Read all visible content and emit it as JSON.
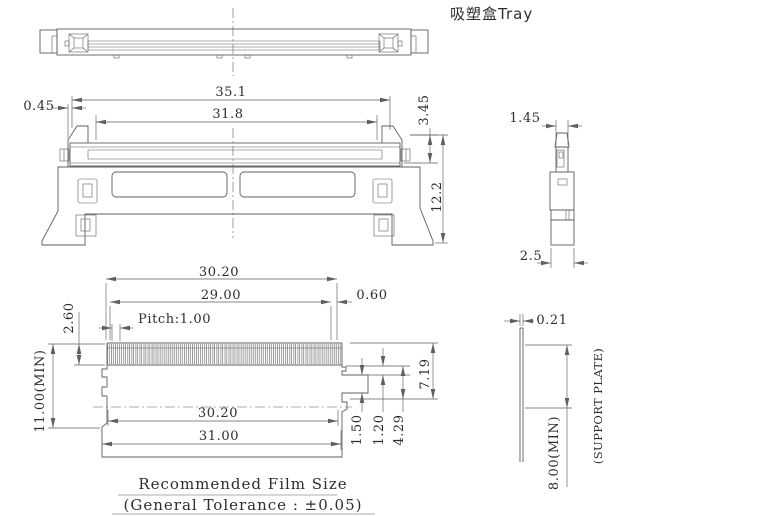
{
  "title": "吸塑盒Tray",
  "front_view": {
    "offset": "0.45",
    "outer_width": "35.1",
    "film_width": "31.8",
    "cap_height": "3.45",
    "total_height": "12.2"
  },
  "side_view": {
    "top_width": "1.45",
    "base_width": "2.5"
  },
  "film_view": {
    "top_width": "30.20",
    "teeth_span": "29.00",
    "pitch": "Pitch:1.00",
    "tooth_height": "2.60",
    "min_height": "11.00(MIN)",
    "edge_margin": "0.60",
    "right_height": "7.19",
    "bottom_width": "30.20",
    "overall_width": "31.00",
    "step_a": "1.50",
    "step_b": "1.20",
    "step_c": "4.29"
  },
  "support_plate_view": {
    "thickness": "0.21",
    "min_height": "8.00(MIN)",
    "label": "(SUPPORT PLATE)"
  },
  "footer": {
    "film_size_label": "Recommended Film Size",
    "tolerance_label": "(General Tolerance :  ±0.05)"
  },
  "colors": {
    "line": "#5f5f5f",
    "text": "#2d2d2d",
    "background": "#ffffff"
  }
}
